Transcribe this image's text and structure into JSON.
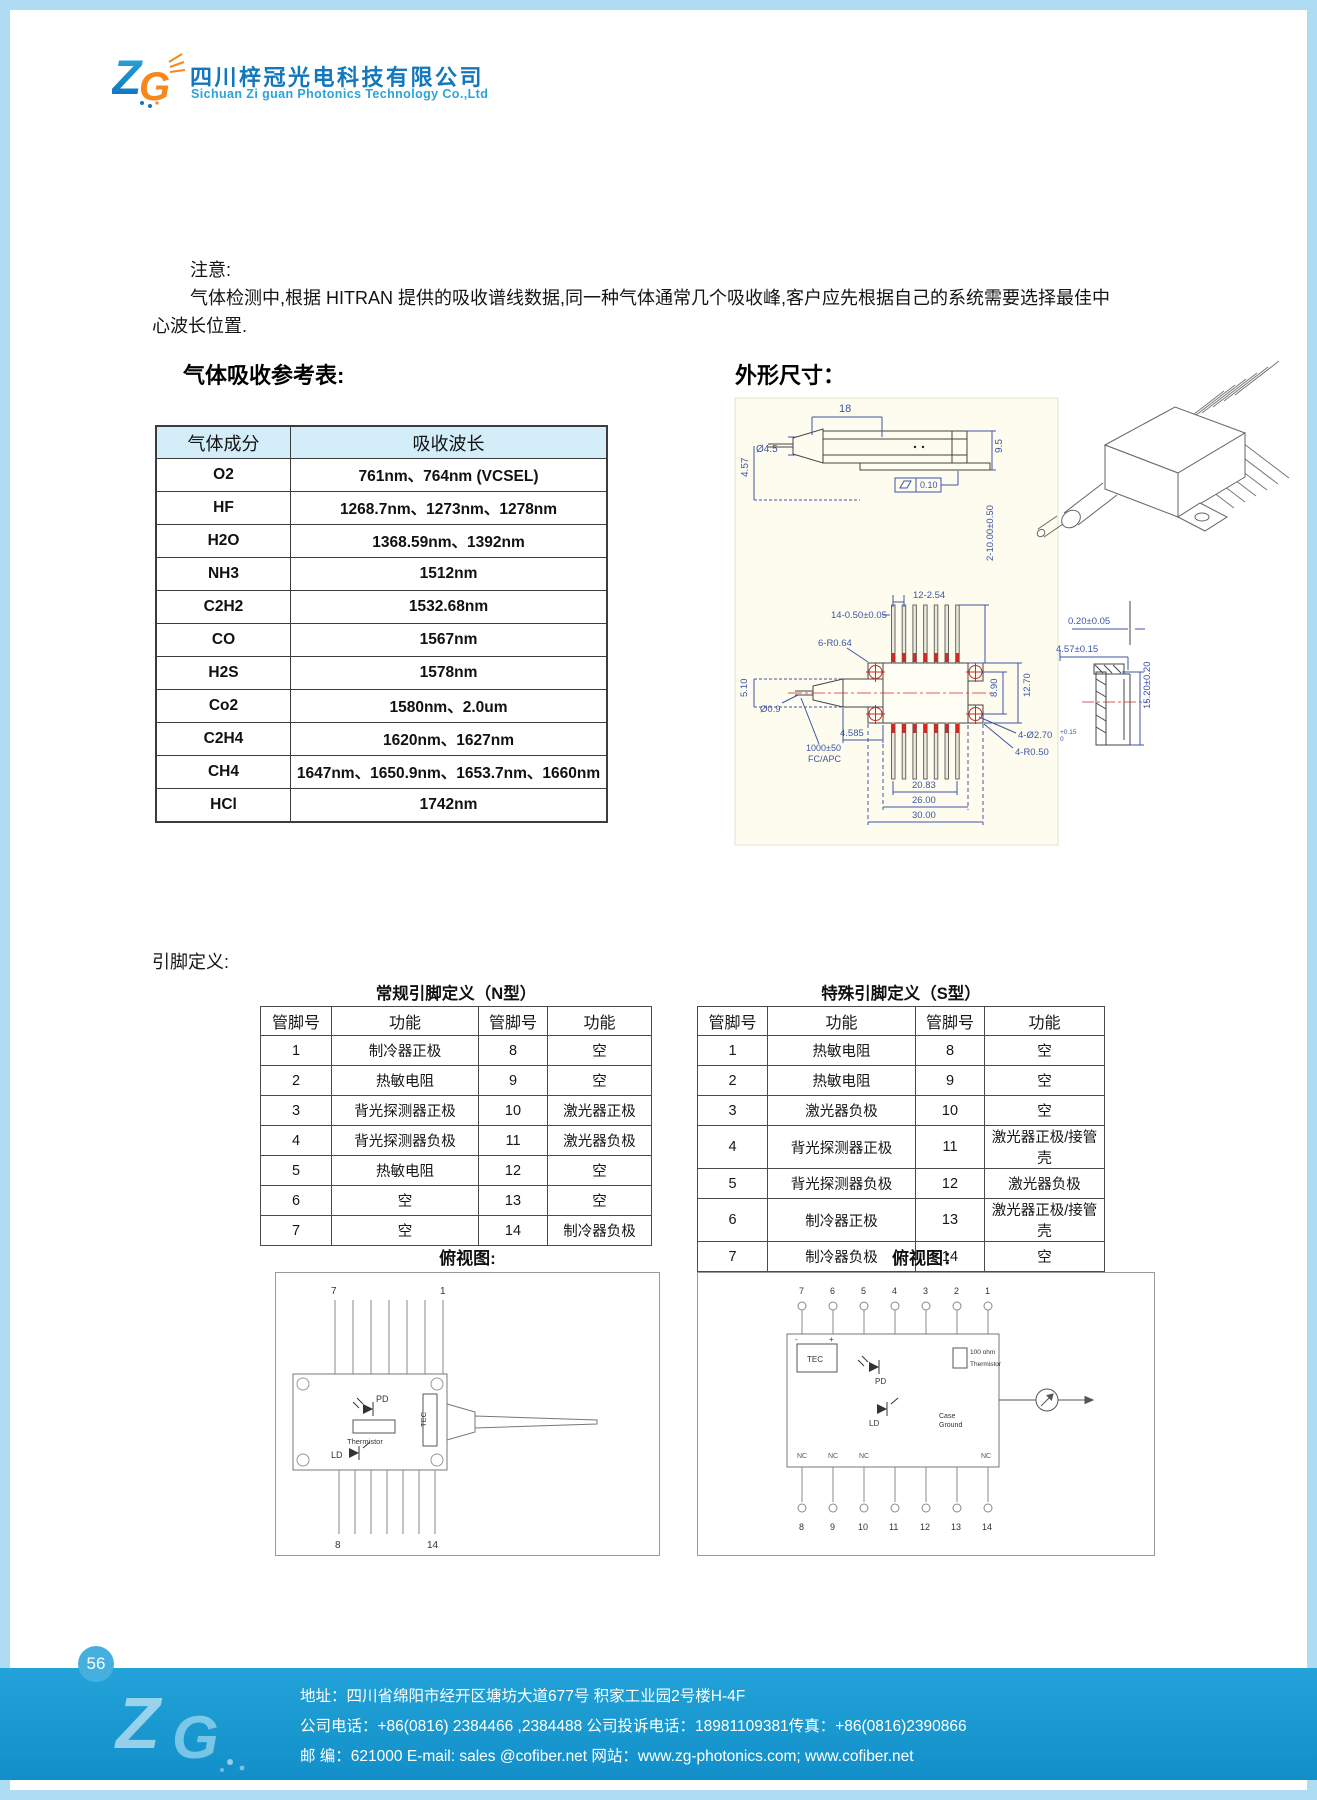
{
  "header": {
    "company_cn": "四川梓冠光电科技有限公司",
    "company_en": "Sichuan Zi guan Photonics Technology Co.,Ltd",
    "logo_z": "Z",
    "logo_g": "G"
  },
  "note": {
    "title": "注意:",
    "line1": "气体检测中,根据 HITRAN 提供的吸收谱线数据,同一种气体通常几个吸收峰,客户应先根据自己的系统需要选择最佳中",
    "line2": "心波长位置."
  },
  "gas_section": {
    "title": "气体吸收参考表:",
    "table": {
      "headers": [
        "气体成分",
        "吸收波长"
      ],
      "rows": [
        [
          "O2",
          "761nm、764nm (VCSEL)"
        ],
        [
          "HF",
          "1268.7nm、1273nm、1278nm"
        ],
        [
          "H2O",
          "1368.59nm、1392nm"
        ],
        [
          "NH3",
          "1512nm"
        ],
        [
          "C2H2",
          "1532.68nm"
        ],
        [
          "CO",
          "1567nm"
        ],
        [
          "H2S",
          "1578nm"
        ],
        [
          "Co2",
          "1580nm、2.0um"
        ],
        [
          "C2H4",
          "1620nm、1627nm"
        ],
        [
          "CH4",
          "1647nm、1650.9nm、1653.7nm、1660nm"
        ],
        [
          "HCl",
          "1742nm"
        ]
      ]
    }
  },
  "outline_section": {
    "title": "外形尺寸：",
    "dims": {
      "top_len": "18",
      "fiber_dia": "Ø4.5",
      "height_front": "4.57",
      "body_h": "9.5",
      "flatness": "0.10",
      "pin_pitch": "12-2.54",
      "pin_w": "14-0.50±0.05",
      "pin_len": "2-10.00±0.50",
      "ear_r": "6-R0.64",
      "nose_h": "5.10",
      "fiber_d": "Ø0.9",
      "nose_len": "4.585",
      "fiber_len": "1000±50",
      "connector": "FC/APC",
      "w1": "20.83",
      "w2": "26.00",
      "w3": "30.00",
      "hole_span": "8.90",
      "body_w": "12.70",
      "hole_dia": "4-Ø2.70",
      "hole_tol": "+0.15",
      "hole_tol_low": "0",
      "corner_r": "4-R0.50",
      "lid": "0.20±0.05",
      "side_h": "4.57±0.15",
      "side_len": "15.20±0.20"
    }
  },
  "pin_section": {
    "label": "引脚定义:",
    "n_table": {
      "title": "常规引脚定义（N型）",
      "headers": [
        "管脚号",
        "功能",
        "管脚号",
        "功能"
      ],
      "rows": [
        [
          "1",
          "制冷器正极",
          "8",
          "空"
        ],
        [
          "2",
          "热敏电阻",
          "9",
          "空"
        ],
        [
          "3",
          "背光探测器正极",
          "10",
          "激光器正极"
        ],
        [
          "4",
          "背光探测器负极",
          "11",
          "激光器负极"
        ],
        [
          "5",
          "热敏电阻",
          "12",
          "空"
        ],
        [
          "6",
          "空",
          "13",
          "空"
        ],
        [
          "7",
          "空",
          "14",
          "制冷器负极"
        ]
      ]
    },
    "s_table": {
      "title": "特殊引脚定义（S型）",
      "headers": [
        "管脚号",
        "功能",
        "管脚号",
        "功能"
      ],
      "rows": [
        [
          "1",
          "热敏电阻",
          "8",
          "空"
        ],
        [
          "2",
          "热敏电阻",
          "9",
          "空"
        ],
        [
          "3",
          "激光器负极",
          "10",
          "空"
        ],
        [
          "4",
          "背光探测器正极",
          "11",
          "激光器正极/接管壳"
        ],
        [
          "5",
          "背光探测器负极",
          "12",
          "激光器负极"
        ],
        [
          "6",
          "制冷器正极",
          "13",
          "激光器正极/接管壳"
        ],
        [
          "7",
          "制冷器负极",
          "14",
          "空"
        ]
      ]
    },
    "n_topview": {
      "label": "俯视图:",
      "pin_top_left": "7",
      "pin_top_right": "1",
      "pin_bottom_left": "8",
      "pin_bottom_right": "14",
      "pd": "PD",
      "tec": "TEC",
      "thermistor": "Thermistor",
      "ld": "LD"
    },
    "s_topview": {
      "label": "俯视图：",
      "top_pins": [
        "7",
        "6",
        "5",
        "4",
        "3",
        "2",
        "1"
      ],
      "bottom_pins": [
        "8",
        "9",
        "10",
        "11",
        "12",
        "13",
        "14"
      ],
      "tec": "TEC",
      "pd": "PD",
      "ld": "LD",
      "res": "100 ohm",
      "thermistor": "Thermistor",
      "case1": "Case",
      "case2": "Ground",
      "nc": "NC"
    }
  },
  "footer": {
    "page_number": "56",
    "line_address": "地址：四川省绵阳市经开区塘坊大道677号 积家工业园2号楼H-4F",
    "line_phone": "公司电话：+86(0816) 2384466 ,2384488  公司投诉电话：18981109381传真：+86(0816)2390866",
    "line_mail": "邮  编：621000  E-mail: sales @cofiber.net     网站：www.zg-photonics.com;  www.cofiber.net"
  },
  "colors": {
    "accent": "#1c9cd5",
    "table_header_bg": "#d3edf9",
    "cad_dim_blue": "#3d55a8",
    "cad_red": "#cc2a22",
    "brand_blue": "#1277bd",
    "brand_orange": "#f5881f",
    "frame_blue": "#aedcf2"
  }
}
